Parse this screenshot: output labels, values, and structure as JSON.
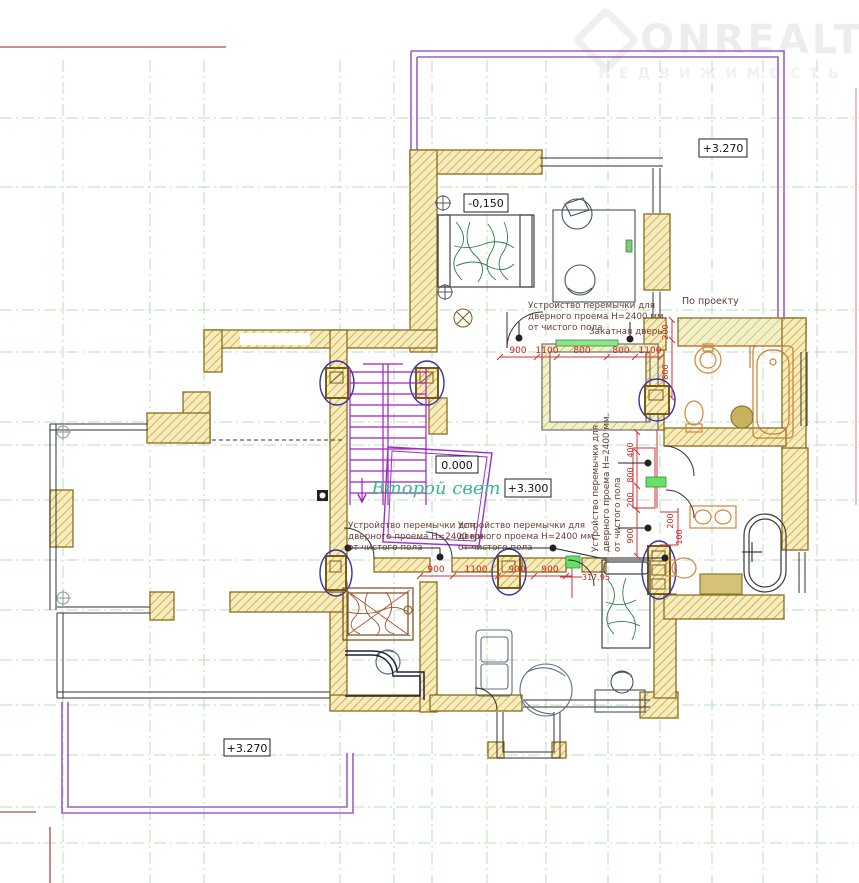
{
  "watermark": {
    "title": "ONREALT",
    "subtitle": "НЕДВИЖИМОСТЬ"
  },
  "elevation_marks": {
    "top_right": "+3.270",
    "bedroom_top": "-0,150",
    "stair_zero": "0.000",
    "hall": "+3.300",
    "bottom_left": "+3.270"
  },
  "room_labels": {
    "second_light": "Второй свет",
    "by_project": "По проекту",
    "rolling_door": "Закатная дверь"
  },
  "annotations": {
    "lintel_note": {
      "line1": "Устройство перемычки для",
      "line2": "дверного проема Н=2400 мм.",
      "line3": "от чистого пола"
    }
  },
  "dimensions": {
    "top_row": [
      "900",
      "1100",
      "800",
      "800",
      "1100"
    ],
    "mid_row": [
      "900",
      "1100",
      "900",
      "900"
    ],
    "offset": "317.95",
    "right_col": [
      "400",
      "800",
      "200",
      "900"
    ],
    "bath_top_col": [
      "200",
      "800"
    ],
    "bath2_col": [
      "200",
      "100"
    ]
  },
  "colors": {
    "wall_tan": "#c8a028",
    "wall_fill": "#f7edc0",
    "roof_purple": "#9b5fc9",
    "stair_magenta": "#a020c0",
    "grid_green": "#b9dcb9",
    "dimension_red": "#cc2222",
    "highlight_green": "#66e166",
    "second_light_green": "#3cb98c",
    "fixture_orange": "#d2873a"
  }
}
